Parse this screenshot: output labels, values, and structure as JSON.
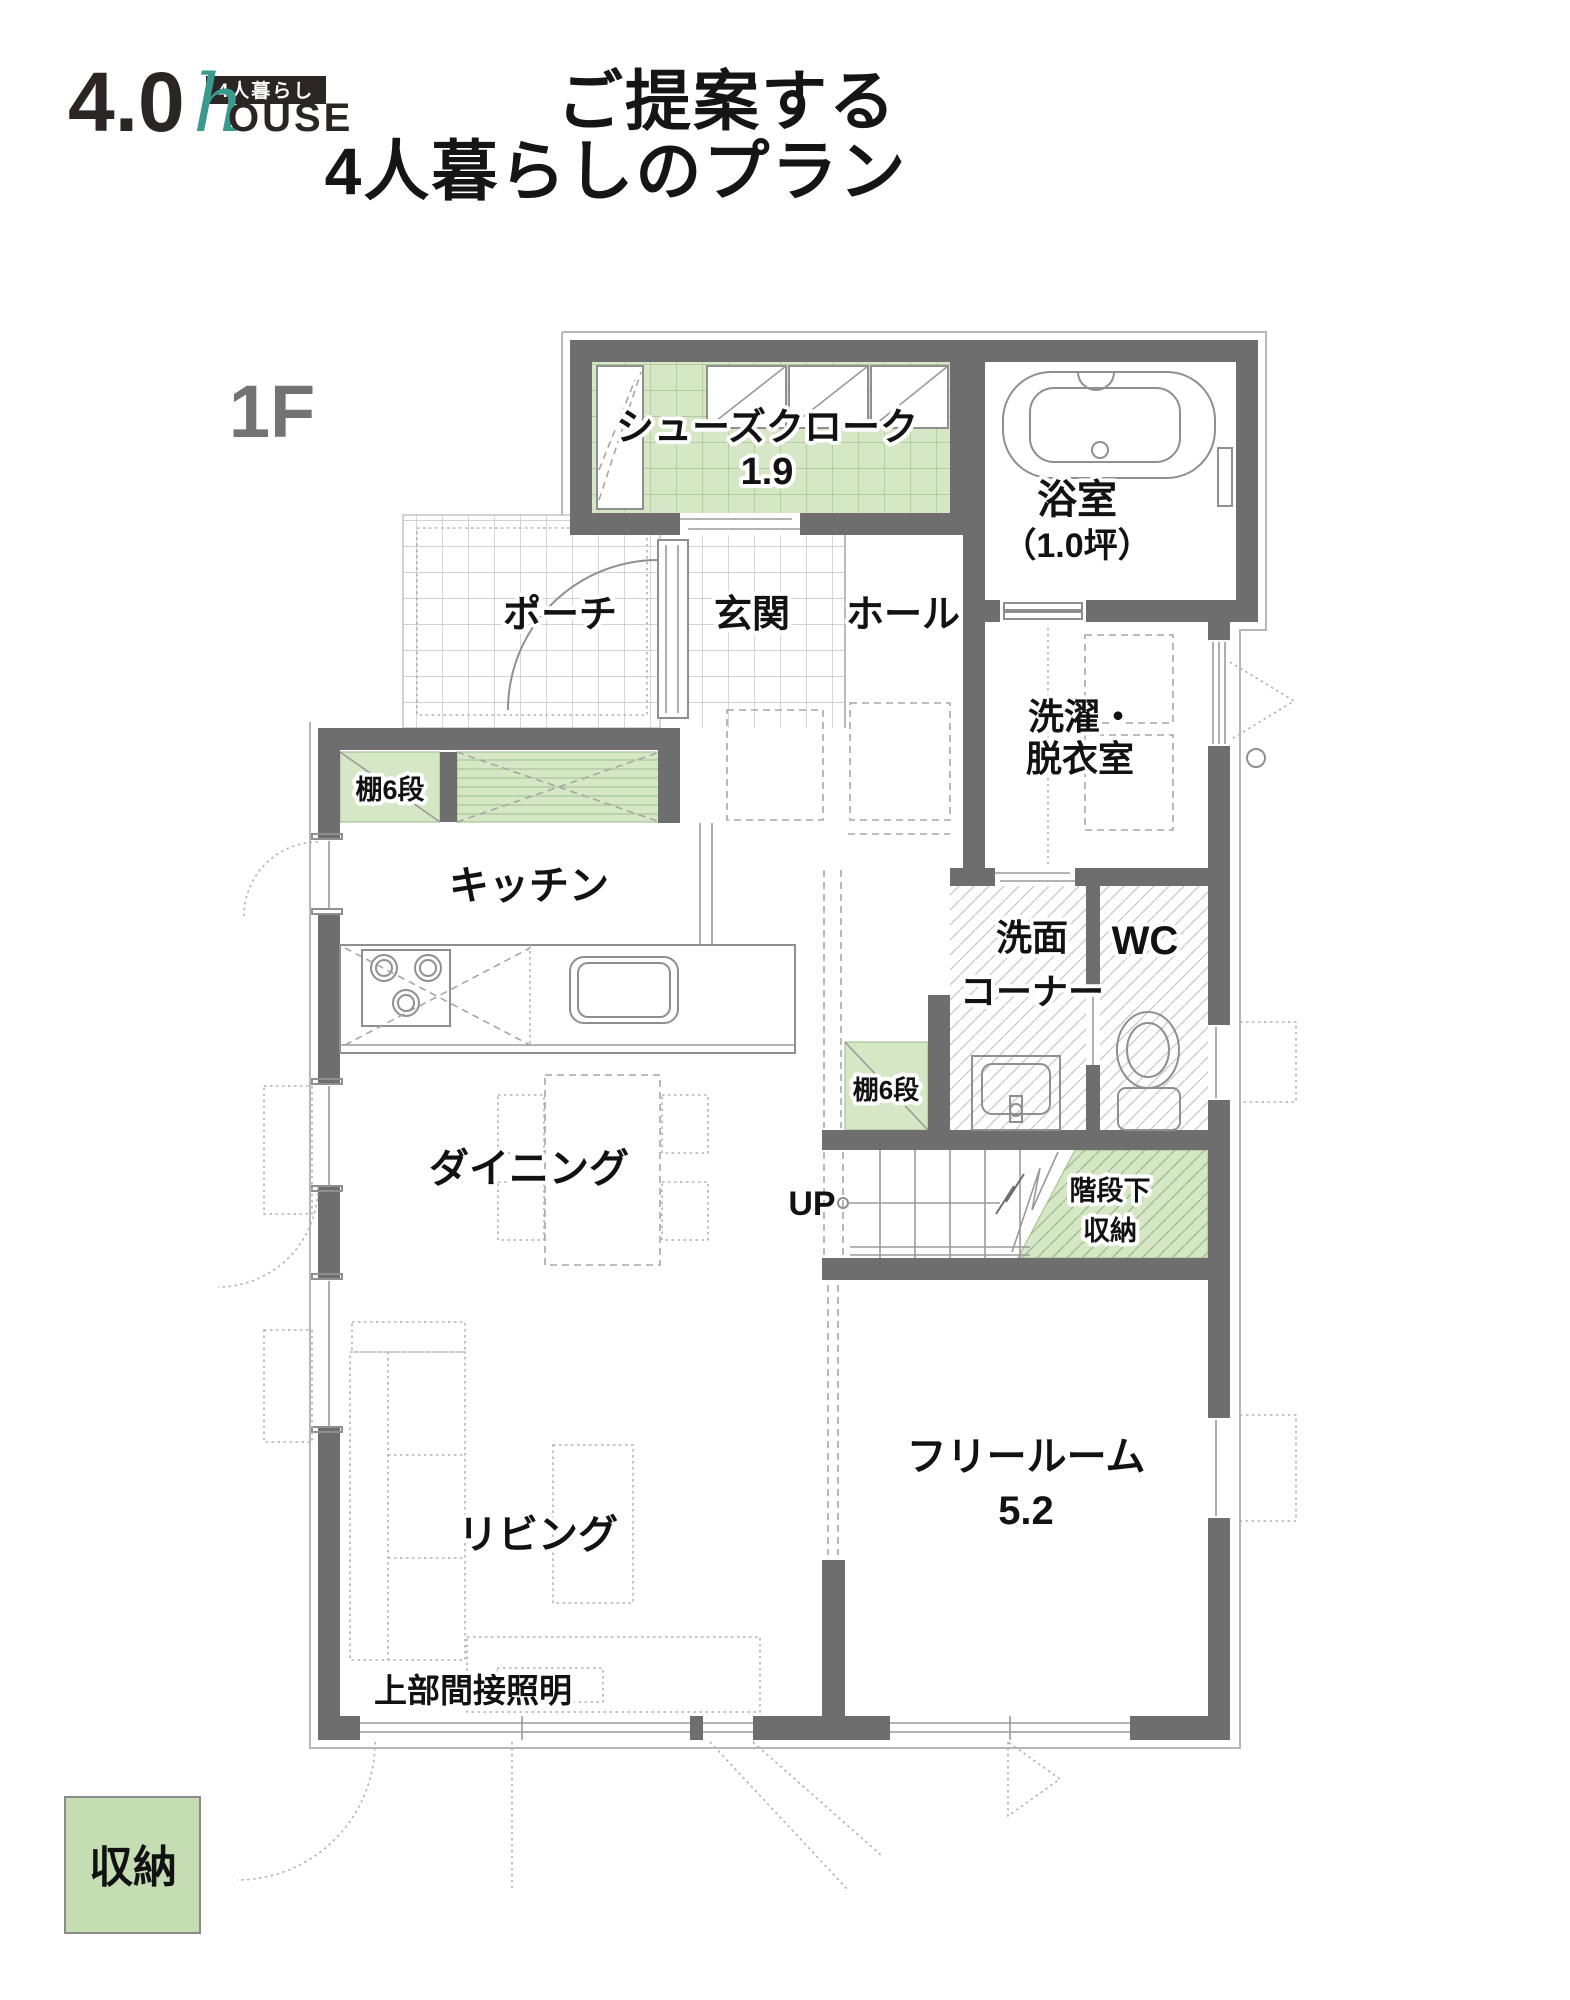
{
  "logo": {
    "number": "4.0",
    "script_h": "h",
    "house": "OUSE",
    "badge": "4人暮らし"
  },
  "title": {
    "line1": "ご提案する",
    "line2": "4人暮らしのプラン"
  },
  "floor": {
    "label": "1F"
  },
  "rooms": {
    "shoe_closet": {
      "name": "シューズクローク",
      "size": "1.9"
    },
    "bath": {
      "name": "浴室",
      "size": "（1.0坪）"
    },
    "porch": {
      "name": "ポーチ"
    },
    "entrance": {
      "name": "玄関"
    },
    "hall": {
      "name": "ホール"
    },
    "laundry": {
      "line1": "洗濯・",
      "line2": "脱衣室"
    },
    "kitchen": {
      "name": "キッチン"
    },
    "wash_corner": {
      "line1": "洗面",
      "line2": "コーナー"
    },
    "wc": {
      "name": "WC"
    },
    "dining": {
      "name": "ダイニング"
    },
    "living": {
      "name": "リビング"
    },
    "free_room": {
      "name": "フリールーム",
      "size": "5.2"
    },
    "under_stair": {
      "line1": "階段下",
      "line2": "収納"
    },
    "shelf_upper": {
      "name": "棚6段"
    },
    "shelf_lower": {
      "name": "棚6段"
    },
    "stairs": {
      "up": "UP"
    },
    "lighting": {
      "name": "上部間接照明"
    }
  },
  "legend": {
    "storage": "収納"
  },
  "colors": {
    "wall": "#6e6e6e",
    "accent_green": "#d6e7c6",
    "legend_green": "#c5ddb3",
    "logo_teal": "#3a9a8d",
    "logo_dark": "#2b2623",
    "floor_gray": "#737373"
  }
}
